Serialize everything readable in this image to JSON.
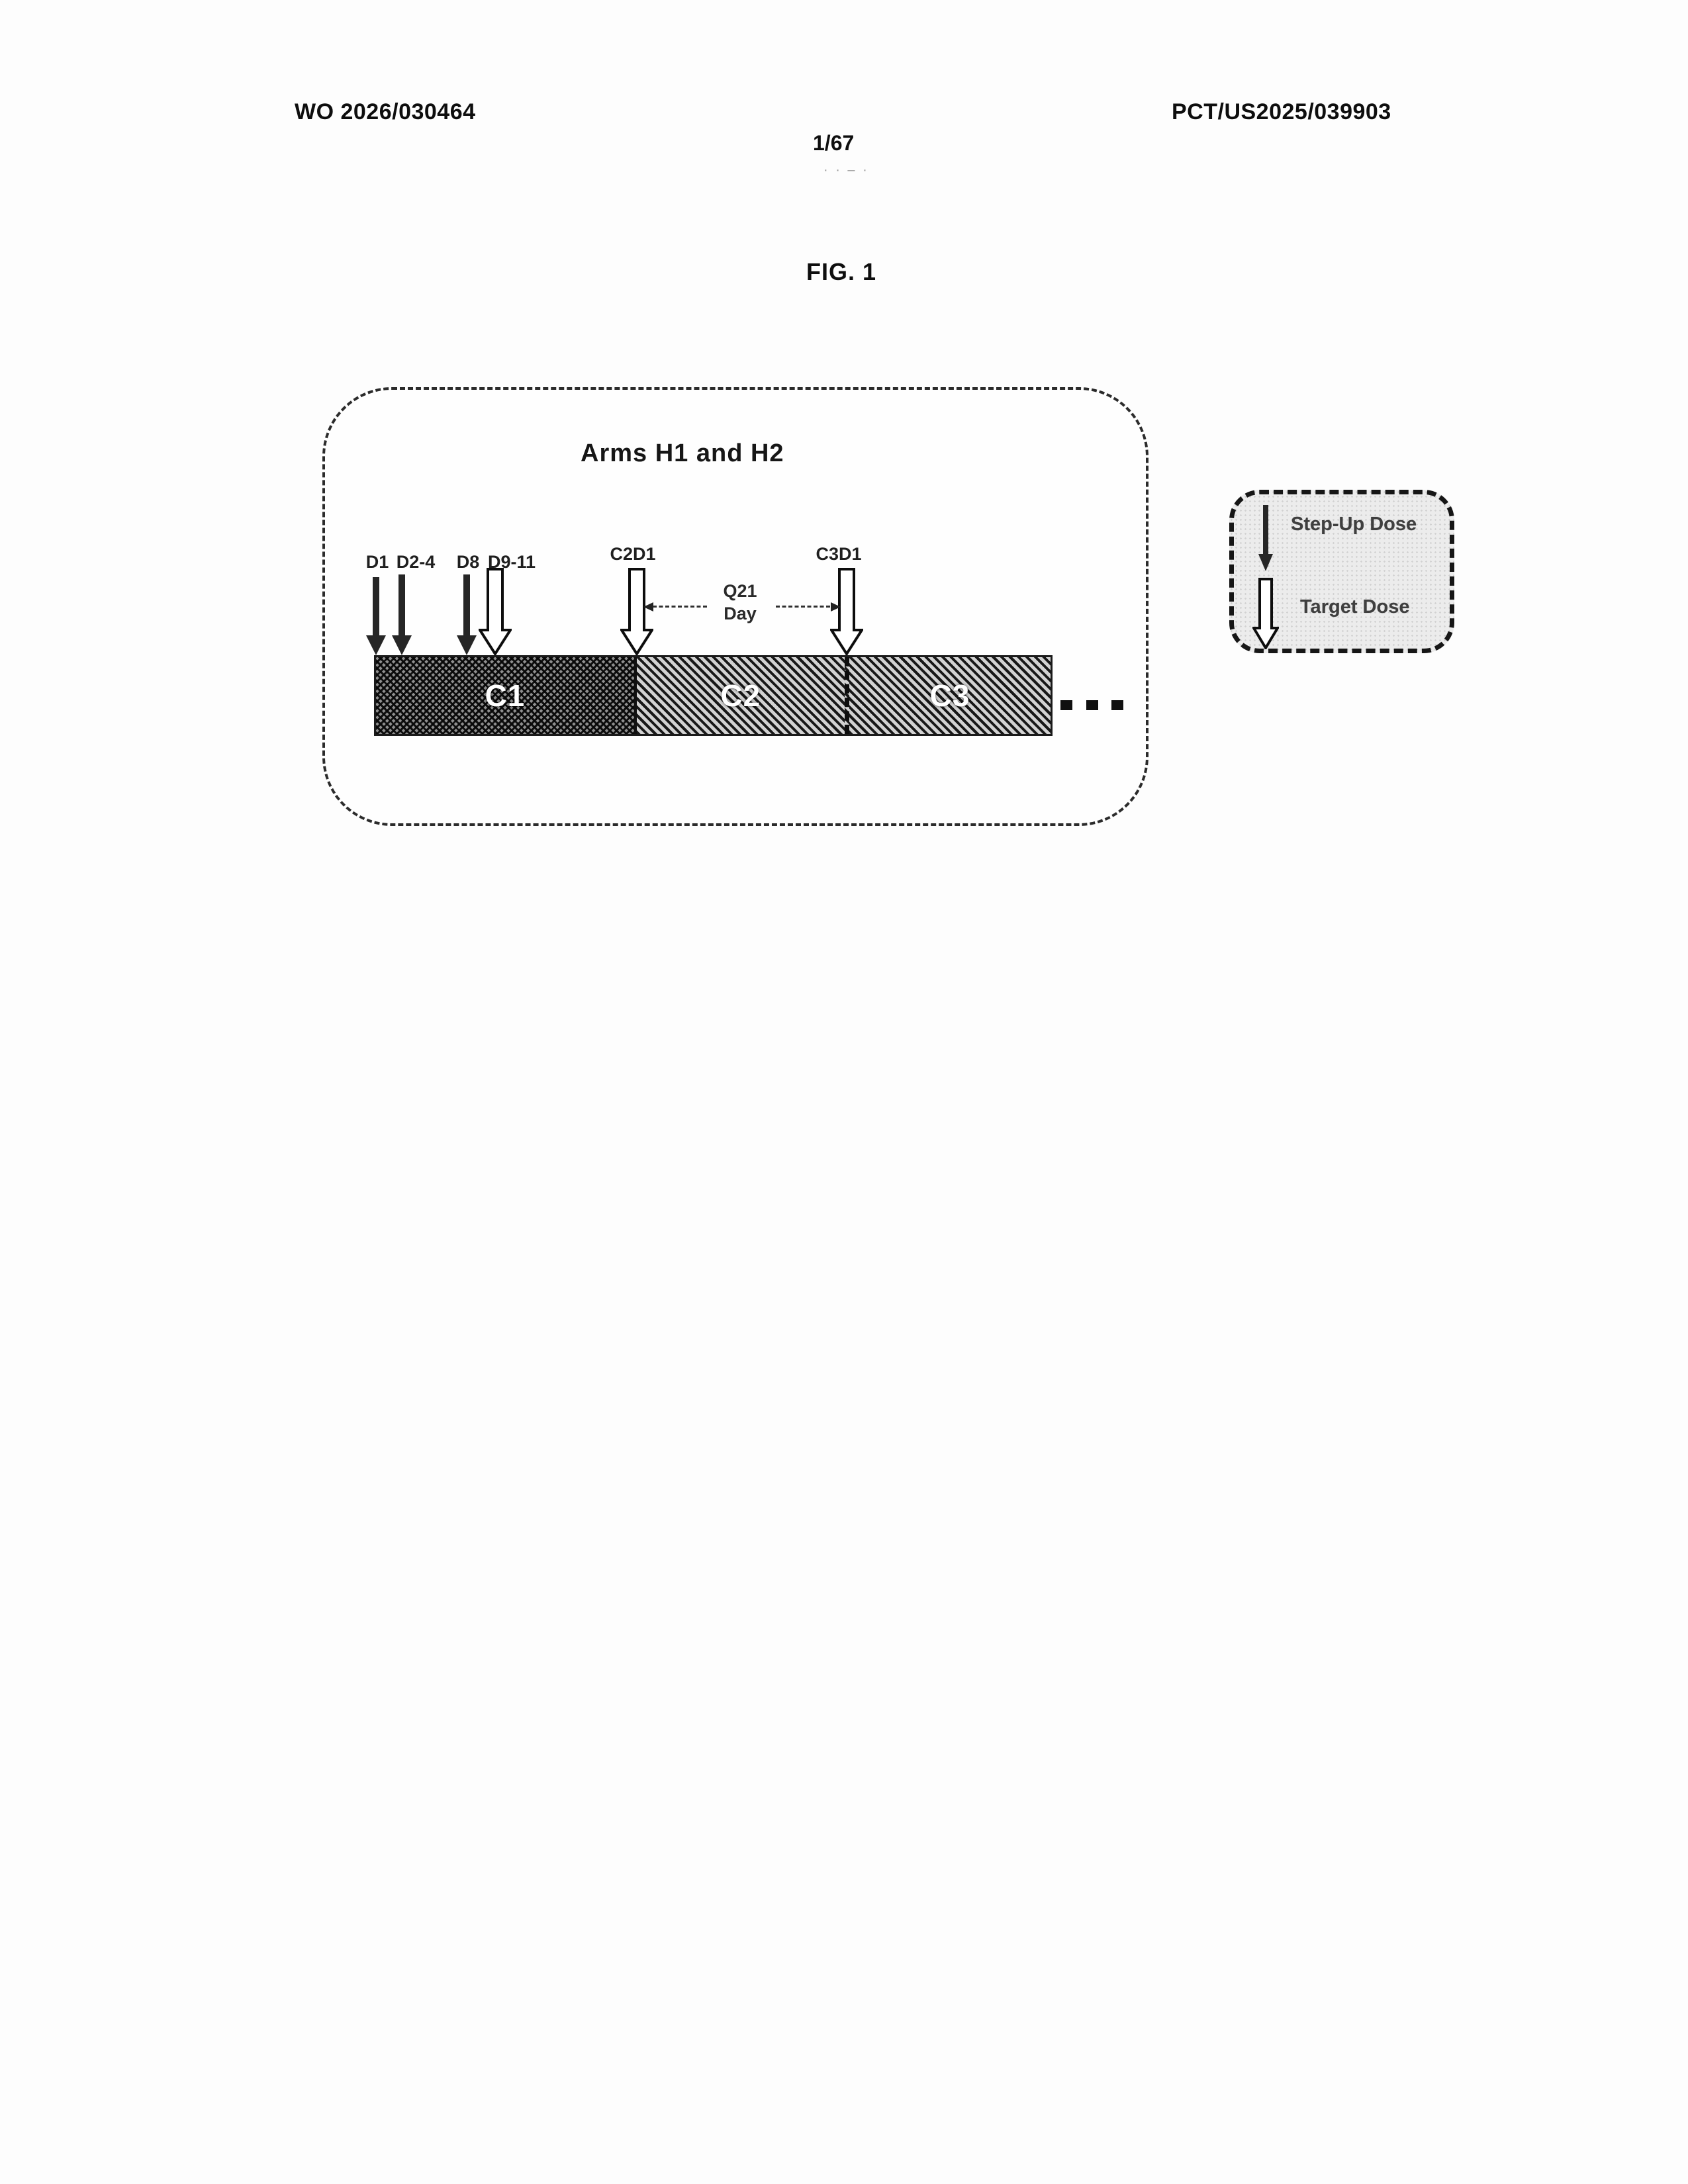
{
  "page": {
    "header_left": "WO 2026/030464",
    "header_right": "PCT/US2025/039903",
    "page_number": "1/67",
    "page_number_marks": "· · – ·",
    "figure_label": "FIG. 1"
  },
  "diagram": {
    "title": "Arms H1 and H2",
    "dose_events": [
      {
        "label": "D1",
        "type": "step-up"
      },
      {
        "label": "D2-4",
        "type": "step-up"
      },
      {
        "label": "D8",
        "type": "step-up"
      },
      {
        "label": "D9-11",
        "type": "target"
      },
      {
        "label": "C2D1",
        "type": "target"
      },
      {
        "label": "C3D1",
        "type": "target"
      }
    ],
    "interval": {
      "line1": "Q21",
      "line2": "Day"
    },
    "cycles": [
      {
        "label": "C1"
      },
      {
        "label": "C2"
      },
      {
        "label": "C3"
      }
    ],
    "continuation_dots": 3
  },
  "legend": {
    "items": [
      {
        "label": "Step-Up Dose",
        "icon": "step-up-arrow-icon"
      },
      {
        "label": "Target Dose",
        "icon": "target-arrow-icon"
      }
    ]
  },
  "colors": {
    "ink": "#111111",
    "arrow_fill_step_up": "#262626",
    "arrow_fill_target": "#ffffff",
    "legend_background": "#ececec"
  }
}
